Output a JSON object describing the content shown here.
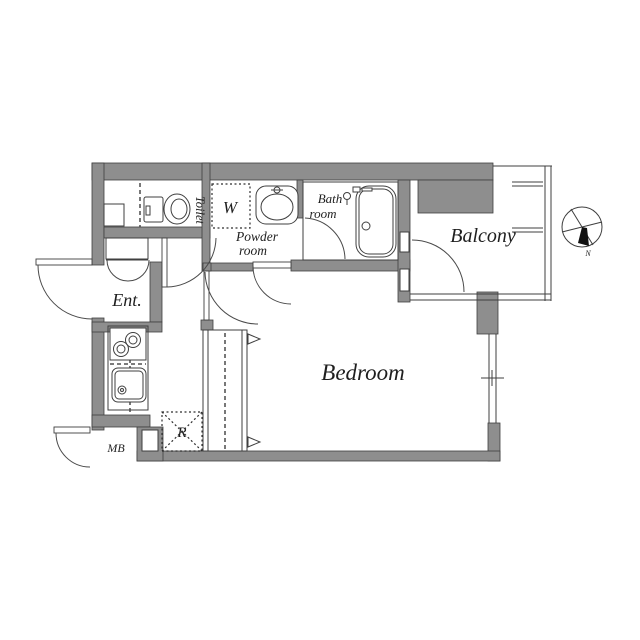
{
  "plan": {
    "type": "apartment-floor-plan",
    "labels": {
      "toilet": "Toilet",
      "closet_w": "W",
      "powder_line1": "Powder",
      "powder_line2": "room",
      "bath_line1": "Bath",
      "bath_line2": "room",
      "balcony": "Balcony",
      "entrance": "Ent.",
      "bedroom": "Bedroom",
      "refrigerator": "R",
      "meter_box": "MB",
      "compass_north": "N"
    },
    "colors": {
      "wall": "#8e8e8e",
      "line": "#3f3f3f",
      "background": "#ffffff",
      "text": "#1f1f1f",
      "compass_needle": "#111111"
    }
  }
}
